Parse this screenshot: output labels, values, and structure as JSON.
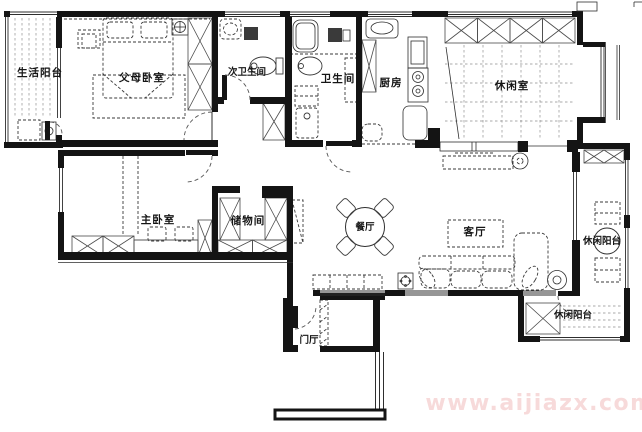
{
  "plan": {
    "watermark": "www.aijiazx.com",
    "colors": {
      "wall": "#141414",
      "watermark": "#f0b6b6"
    },
    "rooms": {
      "life_balcony": {
        "label": "生活阳台"
      },
      "parents_bedroom": {
        "label": "父母卧室"
      },
      "secondary_bathroom": {
        "label": "次卫生间"
      },
      "bathroom": {
        "label": "卫生间"
      },
      "kitchen": {
        "label": "厨房"
      },
      "leisure_room": {
        "label": "休闲室"
      },
      "master_bedroom": {
        "label": "主卧室"
      },
      "storage_room": {
        "label": "储物间"
      },
      "dining_room": {
        "label": "餐厅"
      },
      "living_room": {
        "label": "客厅"
      },
      "leisure_balcony_right": {
        "label": "休闲阳台"
      },
      "leisure_balcony_bottom": {
        "label": "休闲阳台"
      },
      "entrance_hall": {
        "label": "门厅"
      }
    }
  }
}
